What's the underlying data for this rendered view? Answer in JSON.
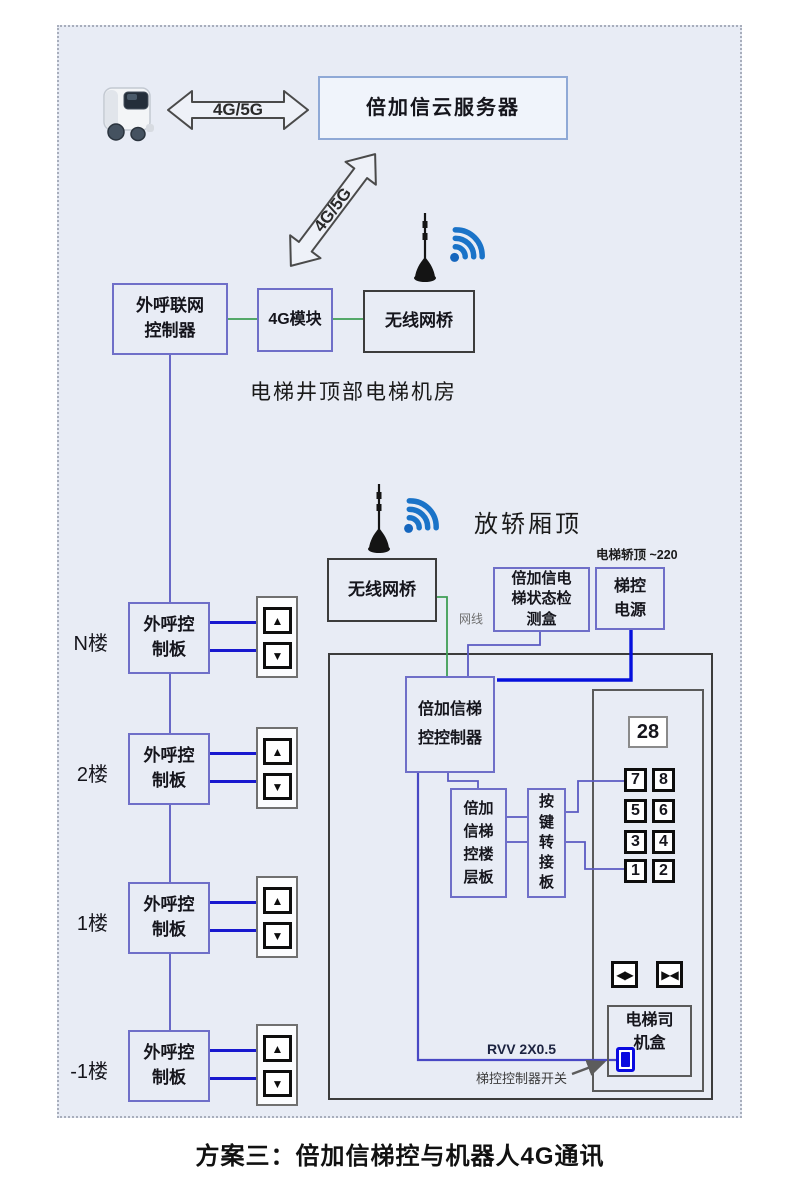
{
  "caption": "方案三：倍加信梯控与机器人4G通讯",
  "icons": {
    "up": "▲",
    "down": "▼",
    "door_open": "◀▶",
    "door_close": "▶◀"
  },
  "colors": {
    "panel_bg": "#e8ecf5",
    "network_cable_green": "#3f9f55",
    "signal_purple": "#5a5ac2",
    "hall_call_blue": "#1818cf",
    "power_blue": "#0510dd",
    "wifi_blue": "#1a73c8",
    "switch_blue": "#0a0ae0"
  },
  "top": {
    "robot_icon": "delivery-robot",
    "link_label": "4G/5G",
    "cloud_server": "倍加信云服务器",
    "diag_link_label": "4G/5G"
  },
  "machine_room": {
    "caption": "电梯井顶部电梯机房",
    "outcall_gateway": {
      "line1": "外呼联网",
      "line2": "控制器"
    },
    "module_4g": "4G模块",
    "wireless_bridge": "无线网桥"
  },
  "car_top": {
    "caption": "放轿厢顶",
    "power_note": "电梯轿顶 ~220",
    "wireless_bridge": "无线网桥",
    "status_box": {
      "line1": "倍加信电",
      "line2": "梯状态检",
      "line3": "测盒"
    },
    "control_power": {
      "line1": "梯控",
      "line2": "电源"
    },
    "cable_label": "网线"
  },
  "cabin": {
    "controller": {
      "line1": "倍加信梯",
      "line2": "控控制器"
    },
    "floor_board": {
      "line1": "倍加",
      "line2": "信梯",
      "line3": "控楼",
      "line4": "层板"
    },
    "key_adapter": {
      "chars": [
        "按",
        "键",
        "转",
        "接",
        "板"
      ]
    },
    "display": "28",
    "floor_buttons": [
      "7",
      "8",
      "5",
      "6",
      "3",
      "4",
      "1",
      "2"
    ],
    "driver_box": {
      "line1": "电梯司",
      "line2": "机盒"
    },
    "cable_label": "RVV 2X0.5",
    "switch_label": "梯控控制器开关"
  },
  "floors": [
    {
      "label": "N楼",
      "board_line1": "外呼控",
      "board_line2": "制板"
    },
    {
      "label": "2楼",
      "board_line1": "外呼控",
      "board_line2": "制板"
    },
    {
      "label": "1楼",
      "board_line1": "外呼控",
      "board_line2": "制板"
    },
    {
      "label": "-1楼",
      "board_line1": "外呼控",
      "board_line2": "制板"
    }
  ]
}
